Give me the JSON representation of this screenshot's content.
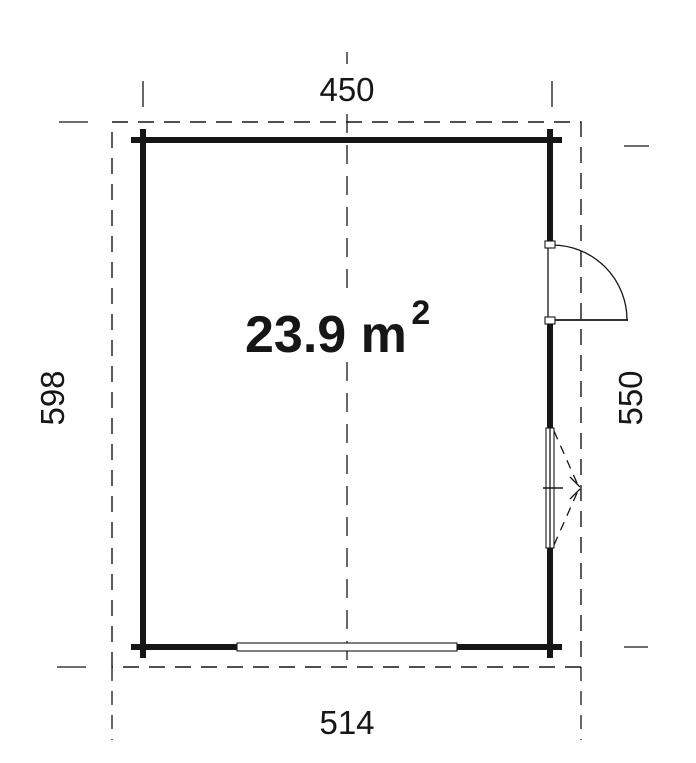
{
  "diagram": {
    "title": "floor-plan",
    "area_label": {
      "value": "23.9 m",
      "superscript": "2"
    },
    "dimensions": {
      "top": "450",
      "left": "598",
      "right": "550",
      "bottom": "514"
    },
    "features": {
      "door": "right-wall-door-swing",
      "window": "right-wall-window",
      "garage_opening": "bottom-wall-opening"
    },
    "colors": {
      "ink": "#161616",
      "background": "#ffffff"
    }
  }
}
